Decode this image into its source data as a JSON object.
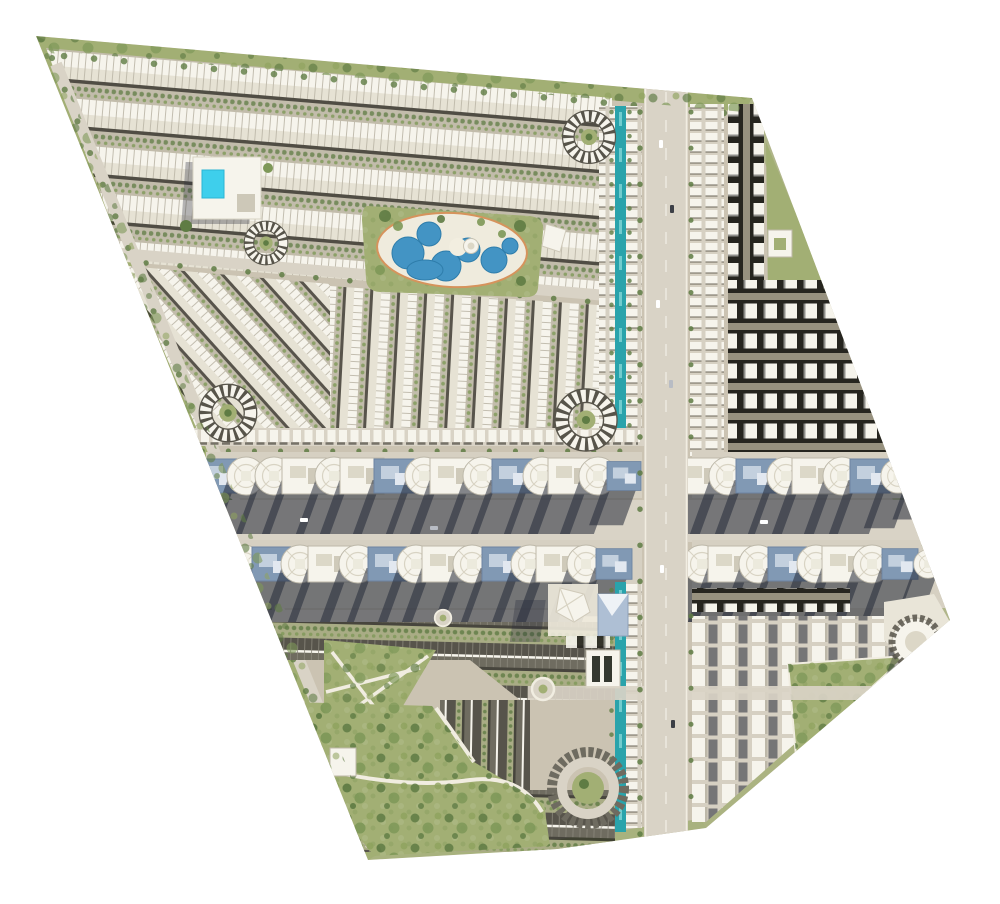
{
  "meta": {
    "title": "Residential community master plan — aerial rendering",
    "canvas": {
      "width": 1000,
      "height": 904
    },
    "view": "top-down site plan, no visible text labels"
  },
  "palette": {
    "ground": "#cbc3b2",
    "plot": "#d6d0c2",
    "roadLight": "#d9d3c6",
    "curb": "#f1ede1",
    "green": "#a2af74",
    "greenDark": "#5f7c44",
    "tree": "#7e9858",
    "grass": "#9fae72",
    "water": "#4394c4",
    "waterDeep": "#2e7dab",
    "pool": "#3ecfec",
    "canal": "#2aa3ab",
    "canalHi": "#8fdede",
    "roofDark": "#26251f",
    "unit": "#f6f4ec",
    "unitBack": "#e6e2d4",
    "unitEdge": "#bdb8a9",
    "gap": "#c2bcab",
    "blue": "#8199b4",
    "blueLight": "#c3d0de",
    "shadow": "rgba(36,41,56,.55)",
    "shadowSoft": "rgba(40,45,60,.32)",
    "roofGray": "#57544b",
    "roofGrayB": "#6f6c60",
    "gapGreen": "#a9ac85",
    "deck": "#efebdd",
    "rim": "#d6935c"
  },
  "site": {
    "outline": "36,36 752,98 950,620 706,828 557,849 368,860"
  },
  "zones": [
    {
      "id": "north-townhouse-district",
      "name": "North townhouse rows"
    },
    {
      "id": "central-lagoon-park",
      "name": "Central lagoon park with white deck"
    },
    {
      "id": "clubhouse",
      "name": "Clubhouse with cyan swimming pool"
    },
    {
      "id": "midwest-townhouse-columns",
      "name": "Mid-west vertical townhouse columns"
    },
    {
      "id": "northeast-apartment-loop",
      "name": "North-east dark apartment loop block"
    },
    {
      "id": "main-boulevard",
      "name": "Main north-south boulevard"
    },
    {
      "id": "central-avenue",
      "name": "Wide east-west avenue between commercial bands"
    },
    {
      "id": "canal-promenade",
      "name": "Teal linear canal promenade"
    },
    {
      "id": "commercial-band-north",
      "name": "Commercial / apartment band north"
    },
    {
      "id": "commercial-band-south",
      "name": "Commercial / apartment band south"
    },
    {
      "id": "southwest-townhouses",
      "name": "South-west gray-roof townhouse district"
    },
    {
      "id": "southwest-park",
      "name": "South-west community park"
    },
    {
      "id": "landmark-cluster",
      "name": "Tent pavilion and blue landmark building"
    },
    {
      "id": "school",
      "name": "School building with two dark courts"
    },
    {
      "id": "southeast-apartment-columns",
      "name": "South-east white apartment columns"
    },
    {
      "id": "southeast-park",
      "name": "Triangular south-east park"
    },
    {
      "id": "corner-building",
      "name": "Curved building at east corner"
    }
  ],
  "features": {
    "crescent_culdesacs": 4,
    "roundabouts": 2,
    "lagoon_pool_basins": 7,
    "clubhouse_pool": 1,
    "canal_segments": 2,
    "commercial_buildings_band_north": 24,
    "commercial_buildings_band_south": 23
  }
}
